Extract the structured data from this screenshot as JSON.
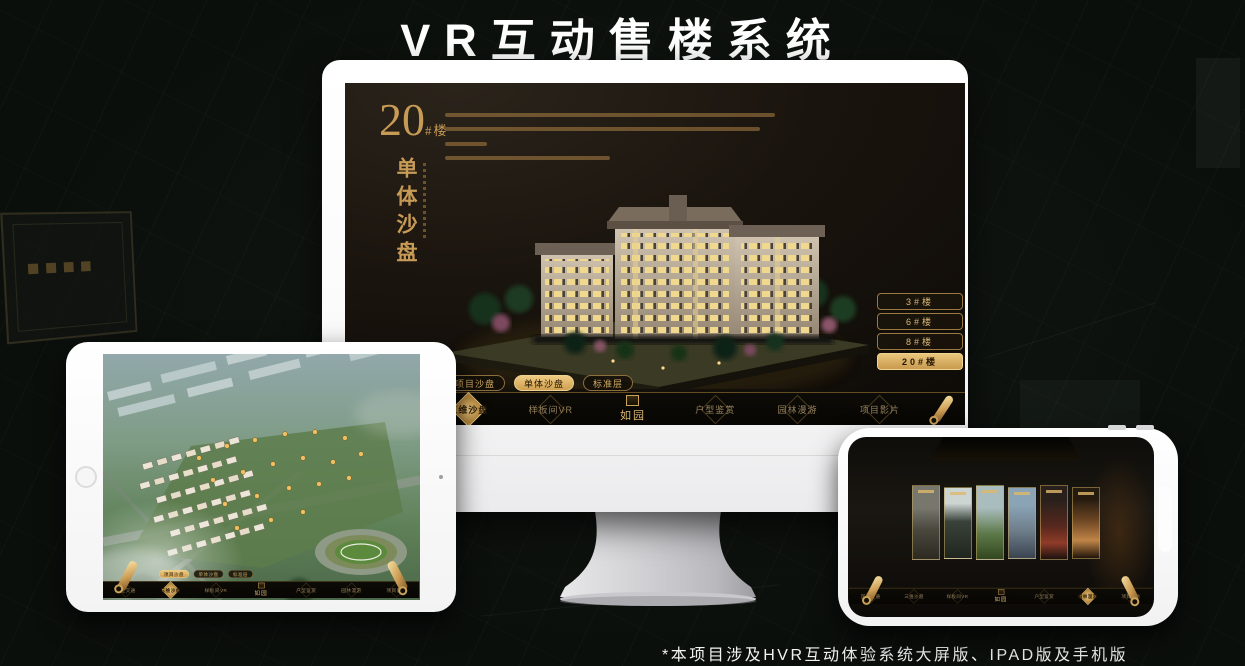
{
  "header": {
    "title": "VR互动售楼系统"
  },
  "footer": {
    "note": "*本项目涉及HVR互动体验系统大屏版、IPAD版及手机版"
  },
  "brand": {
    "logo": "如园"
  },
  "nav": {
    "items": [
      "区位交通",
      "三维沙盘",
      "样板间VR",
      "户型鉴赏",
      "园林漫游",
      "项目影片"
    ],
    "monitor_active": "三维沙盘",
    "tablet_active": "三维沙盘",
    "phone_active": "园林漫游"
  },
  "sub_tabs": {
    "items": [
      "项目沙盘",
      "单体沙盘",
      "标准层"
    ],
    "monitor_active": "单体沙盘",
    "tablet_active": "项目沙盘"
  },
  "monitor": {
    "building_number": "20",
    "building_unit": "#楼",
    "section_title": "单体沙盘",
    "floor_buttons": [
      "3#楼",
      "6#楼",
      "8#楼",
      "20#楼"
    ],
    "active_floor": "20#楼"
  },
  "colors": {
    "gold": "#c79a52",
    "gold_bright": "#ecca84",
    "screen_dark": "#17120d"
  }
}
